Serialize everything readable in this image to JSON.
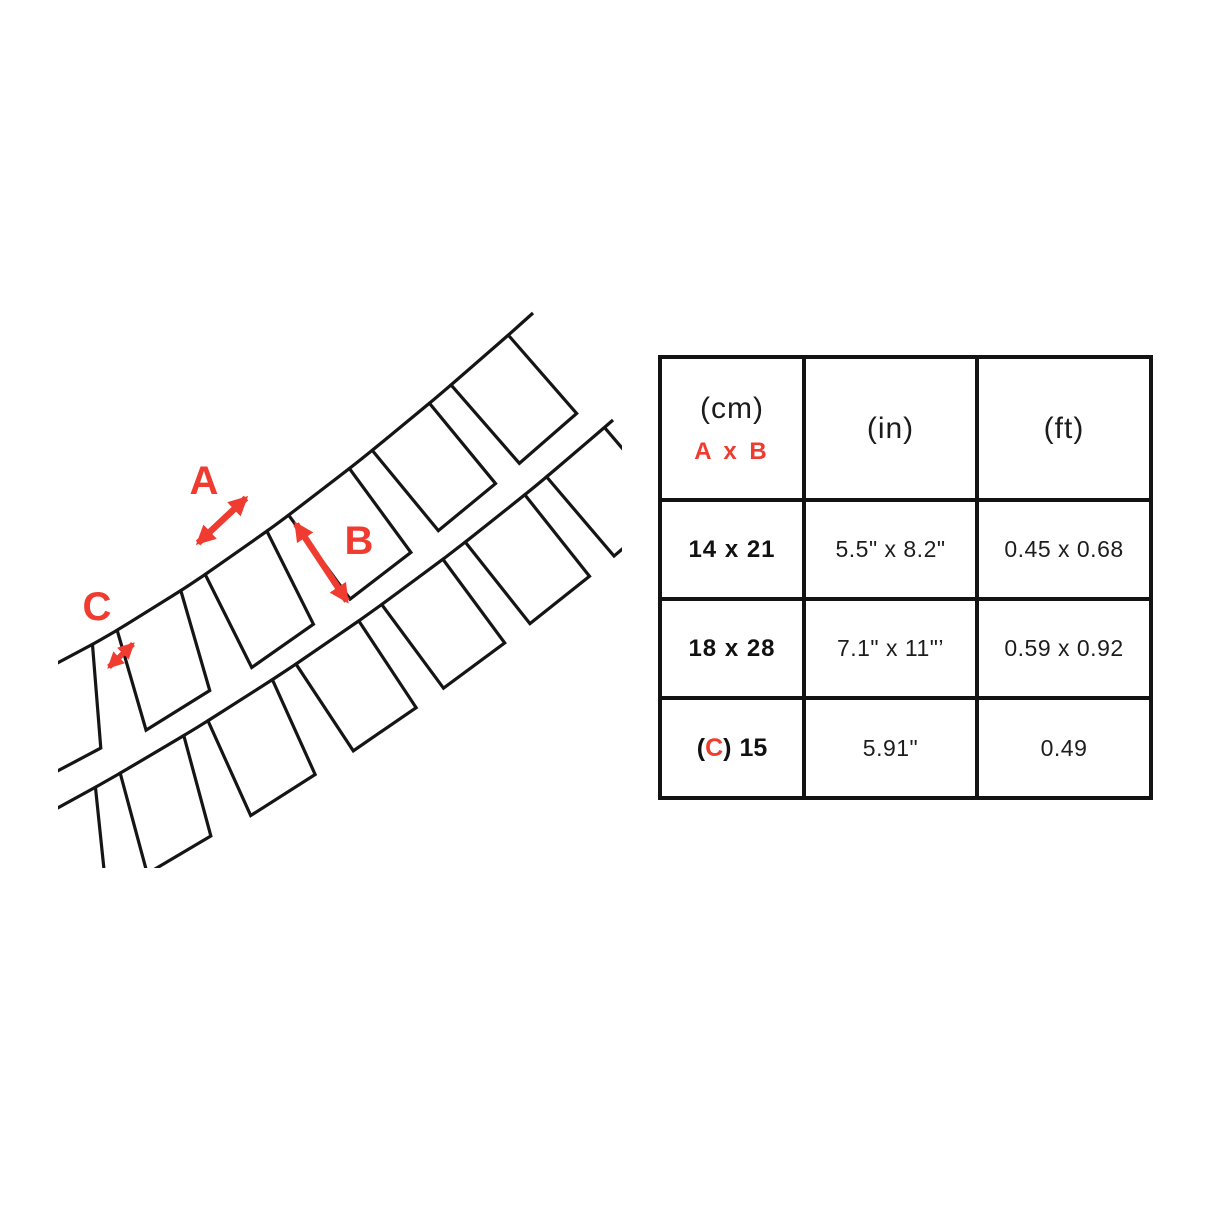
{
  "diagram": {
    "label_a": "A",
    "label_b": "B",
    "label_c": "C",
    "arrow_color": "#EF3B30",
    "line_color": "#151515"
  },
  "table": {
    "header": {
      "unit_cm": "(cm)",
      "dims_label": "A x B",
      "unit_in": "(in)",
      "unit_ft": "(ft)"
    },
    "rows": [
      {
        "cm": "14 x 21",
        "inches": "5.5\" x 8.2\"",
        "feet": "0.45 x 0.68"
      },
      {
        "cm": "18 x 28",
        "inches": "7.1\" x 11\"’",
        "feet": "0.59 x 0.92"
      }
    ],
    "row_c": {
      "open": "(",
      "c": "C",
      "close": ")",
      "value": "15",
      "inches": "5.91\"",
      "feet": "0.49"
    }
  }
}
